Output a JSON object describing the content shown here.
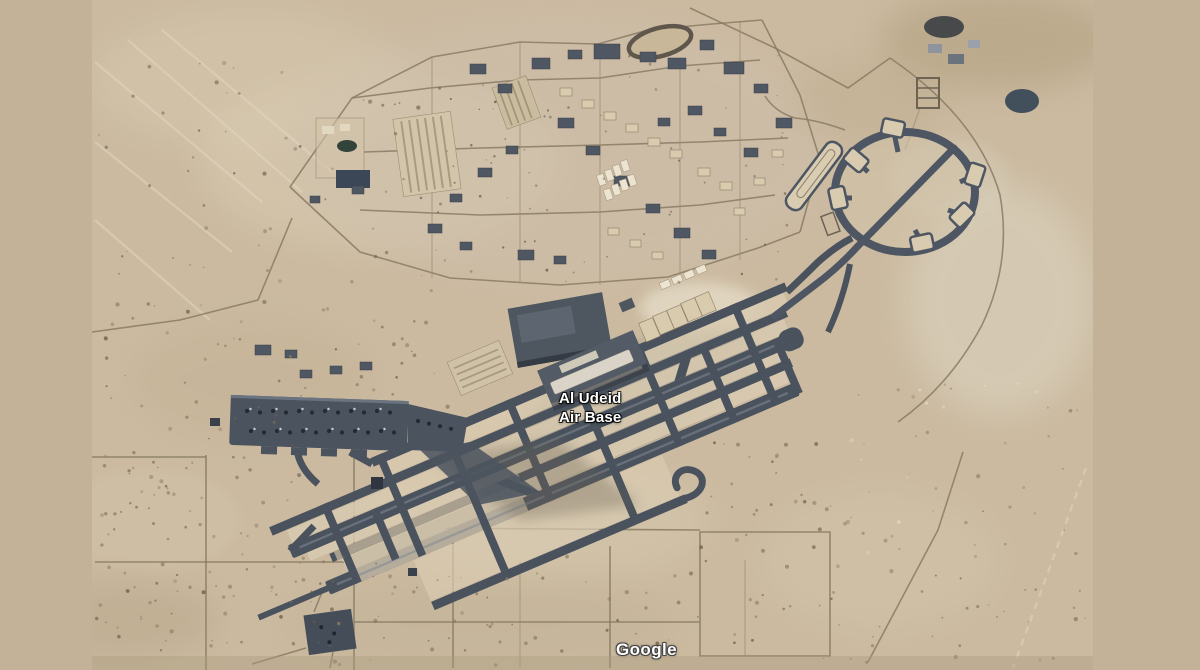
{
  "window": {
    "width": 1200,
    "height": 670
  },
  "map": {
    "kind": "satellite-imagery",
    "place_label": {
      "line1": "Al Udeid",
      "line2": "Air Base"
    },
    "attribution": "Google",
    "colors": {
      "letterbox": "#c4b298",
      "desert": "#cbbaa0",
      "desert_light": "#dacdb3",
      "pavement": "#49525d",
      "apron": "#4b535f",
      "label_text": "#ffffff"
    }
  }
}
